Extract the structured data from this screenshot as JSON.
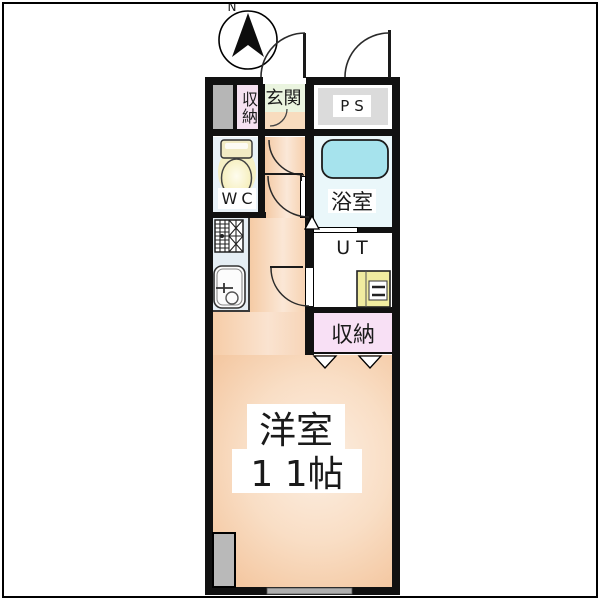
{
  "plan_type": "floor-plan",
  "compass": {
    "north_label": "N"
  },
  "rooms": {
    "storage_top": {
      "label": "収納"
    },
    "entrance": {
      "label": "玄関"
    },
    "pipe_space": {
      "label": "PS"
    },
    "toilet": {
      "label": "WC"
    },
    "bathroom": {
      "label": "浴室"
    },
    "utility": {
      "label": "UT"
    },
    "closet": {
      "label": "収納"
    },
    "main_room": {
      "name": "洋室",
      "size": "1 1帖"
    }
  },
  "fixtures": [
    "compass-icon",
    "toilet-icon",
    "bathtub-icon",
    "gas-stove-icon",
    "kitchen-sink-icon",
    "water-heater-icon",
    "door-swing-arc",
    "folding-closet-door",
    "window",
    "pillar"
  ],
  "colors": {
    "wall": "#111111",
    "main_floor_peach": "#F8DCC2",
    "entrance_green": "#EAF4DF",
    "entrance_tile": "#F8DCBE",
    "storage_pink": "#F8E0F5",
    "wc_blue": "#E9F2F8",
    "bathroom_blue": "#EAF7FA",
    "bathtub_cyan": "#A6E3ED",
    "kitchen_counter_blue": "#E5EEF4",
    "ps_gray": "#DBDBDB",
    "pillar_gray": "#B6B6B6",
    "water_heater_yellow": "#F1ECA0",
    "toilet_tank_cream": "#F2EBC4",
    "window_gray": "#AEAEAE"
  }
}
